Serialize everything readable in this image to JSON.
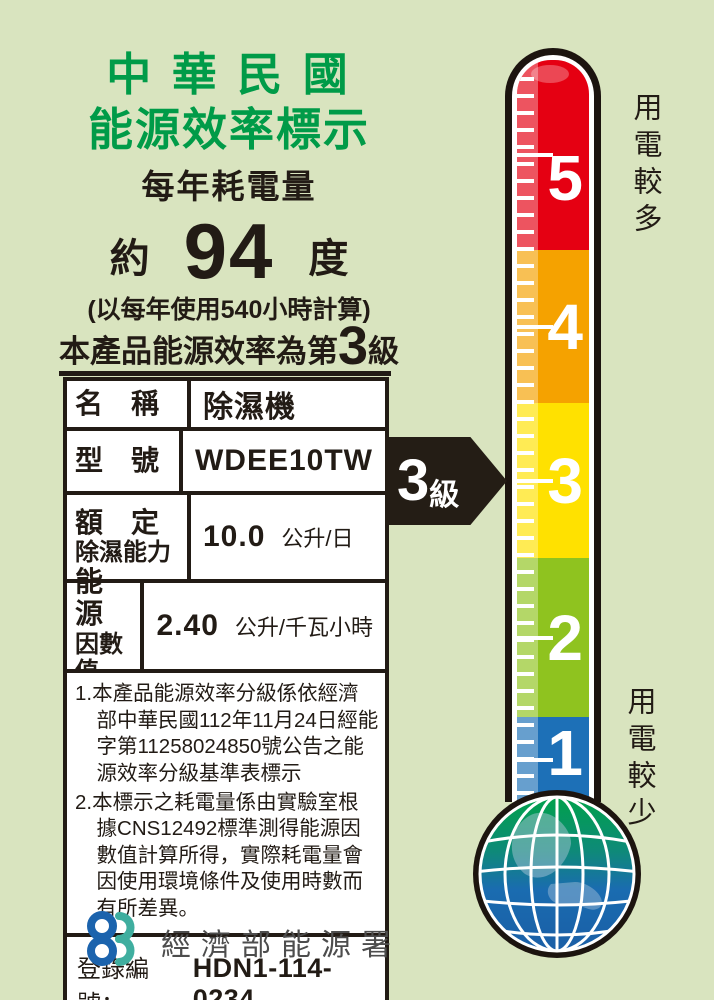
{
  "colors": {
    "background": "#d9e4bf",
    "title_green": "#009b48",
    "text_black": "#221b15",
    "arrow_black": "#241d15",
    "logo_blue": "#1b63ad",
    "logo_teal": "#3fae9f"
  },
  "header": {
    "title_line1": "中 華 民 國",
    "title_line2": "能源效率標示",
    "subtitle": "每年耗電量"
  },
  "consumption": {
    "approx": "約",
    "value": "94",
    "unit": "度",
    "basis": "(以每年使用540小時計算)"
  },
  "grade_statement": {
    "prefix": "本產品能源效率為第",
    "grade": "3",
    "suffix": "級"
  },
  "table": {
    "rows": [
      {
        "label": "名　稱",
        "label2": "",
        "value": "除濕機",
        "unit": ""
      },
      {
        "label": "型　號",
        "label2": "",
        "value": "WDEE10TW",
        "unit": ""
      },
      {
        "label": "額　定",
        "label2": "除濕能力",
        "value": "10.0",
        "unit": "公升/日"
      },
      {
        "label": "能　源",
        "label2": "因數值",
        "value": "2.40",
        "unit": "公升/千瓦小時"
      }
    ]
  },
  "notes": [
    "1.本產品能源效率分級係依經濟部中華民國112年11月24日經能字第11258024850號公告之能源效率分級基準表標示",
    "2.本標示之耗電量係由實驗室根據CNS12492標準測得能源因數值計算所得，實際耗電量會因使用環境條件及使用時數而有所差異。"
  ],
  "registration": {
    "label": "登錄編號：",
    "value": "HDN1-114-0234"
  },
  "footer": {
    "agency": "經濟部能源署"
  },
  "arrow": {
    "grade": "3",
    "suffix": "級"
  },
  "thermometer": {
    "top_label": "用電較多",
    "bottom_label": "用電較少",
    "segments": [
      {
        "grade": "5",
        "color": "#e50012"
      },
      {
        "grade": "4",
        "color": "#f5a200"
      },
      {
        "grade": "3",
        "color": "#ffe100"
      },
      {
        "grade": "2",
        "color": "#8fc31f"
      },
      {
        "grade": "1",
        "color": "#1d70b7"
      }
    ]
  }
}
